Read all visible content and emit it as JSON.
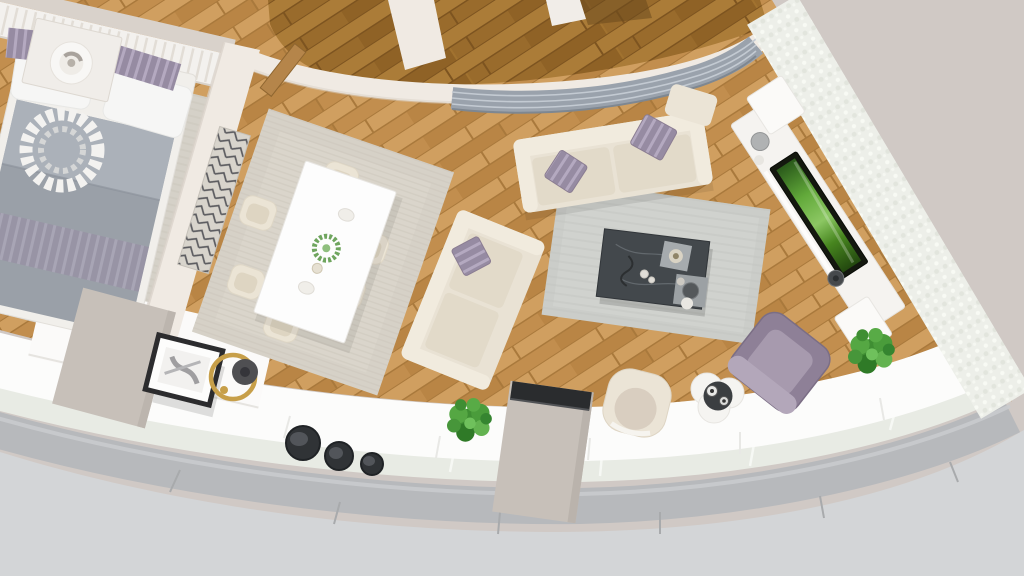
{
  "scene": {
    "type": "3d-floorplan-render",
    "view": "top-down",
    "rooms": [
      {
        "name": "bedroom",
        "items": [
          "bed",
          "gray-duvet",
          "white-pillows",
          "striped-lavender-pillows",
          "decor-wreath",
          "nightstand",
          "table-lamp",
          "area-rug",
          "headboard-panel-wall"
        ]
      },
      {
        "name": "dining-area",
        "items": [
          "white-dining-table",
          "six-cream-chairs",
          "beige-rug",
          "green-centerpiece",
          "wall-radiator-panel",
          "open-wood-door"
        ]
      },
      {
        "name": "living-area",
        "items": [
          "cream-sofa-large",
          "cream-sofa-small",
          "purple-accent-pillows",
          "gray-rug",
          "dark-marble-coffee-table",
          "decor-trays",
          "purple-armchair",
          "cream-tub-chair",
          "cloud-side-table",
          "column-with-dark-top"
        ]
      },
      {
        "name": "media-wall",
        "items": [
          "white-tv-console",
          "flat-tv-green-screen",
          "vases",
          "white-brick-wall"
        ]
      },
      {
        "name": "balcony-curve",
        "items": [
          "white-sill",
          "glass-band",
          "gray-outer-rim",
          "three-dark-stools",
          "leaning-picture-frame",
          "gold-arc-floor-lamp",
          "potted-plant-left",
          "potted-plant-right",
          "white-sideboard",
          "beige-column"
        ]
      },
      {
        "name": "hallway",
        "items": [
          "dark-wood-floor",
          "curved-wall",
          "louvered-vent-panel",
          "doorway"
        ]
      }
    ]
  },
  "palette": {
    "bgBeige": "#d0c9c5",
    "bgGray": "#d3d5d7",
    "rim": "#b7b9bc",
    "rimHi": "#c9cbcd",
    "glass": "#e8ebe4",
    "sill": "#fcfcfb",
    "wood1": "#c79350",
    "wood2": "#d09f60",
    "wood3": "#b98545",
    "wood4": "#c28e4e",
    "woodSeam": "#a9793c",
    "woodD1": "#a1722f",
    "woodD2": "#ab7c38",
    "woodD3": "#8f6226",
    "woodD4": "#996b2c",
    "woodDSeam": "#7d5420",
    "wall": "#f0eae3",
    "wallShadow": "#d9d1c8",
    "brick": "#edefe9",
    "louver": "#9aa2ac",
    "rugBedroom": "#d5d1c8",
    "rugDining": "#d6d1c7",
    "rugLiving": "#cbcdc9",
    "sofa": "#e9e2d4",
    "sofaCushion": "#e2dac9",
    "sofaTrim": "#f1ebde",
    "pillowPurple": "#968ba2",
    "pillowStripe": "#b4a9c0",
    "duvet": "#9aa0a8",
    "duvetSheen": "#aeb4bc",
    "marble": "#43484c",
    "pillar": "#c7c0b9",
    "pillarTop": "#2a2c2e",
    "plant": "#3f8e33",
    "tvGreen": "#62a93a",
    "armchair": "#8e8097",
    "gold": "#c79f49",
    "stool": "#303336",
    "tableWhite": "#fdfdfd",
    "frameDark": "#2c2c2e",
    "white": "#f5f3f0"
  }
}
